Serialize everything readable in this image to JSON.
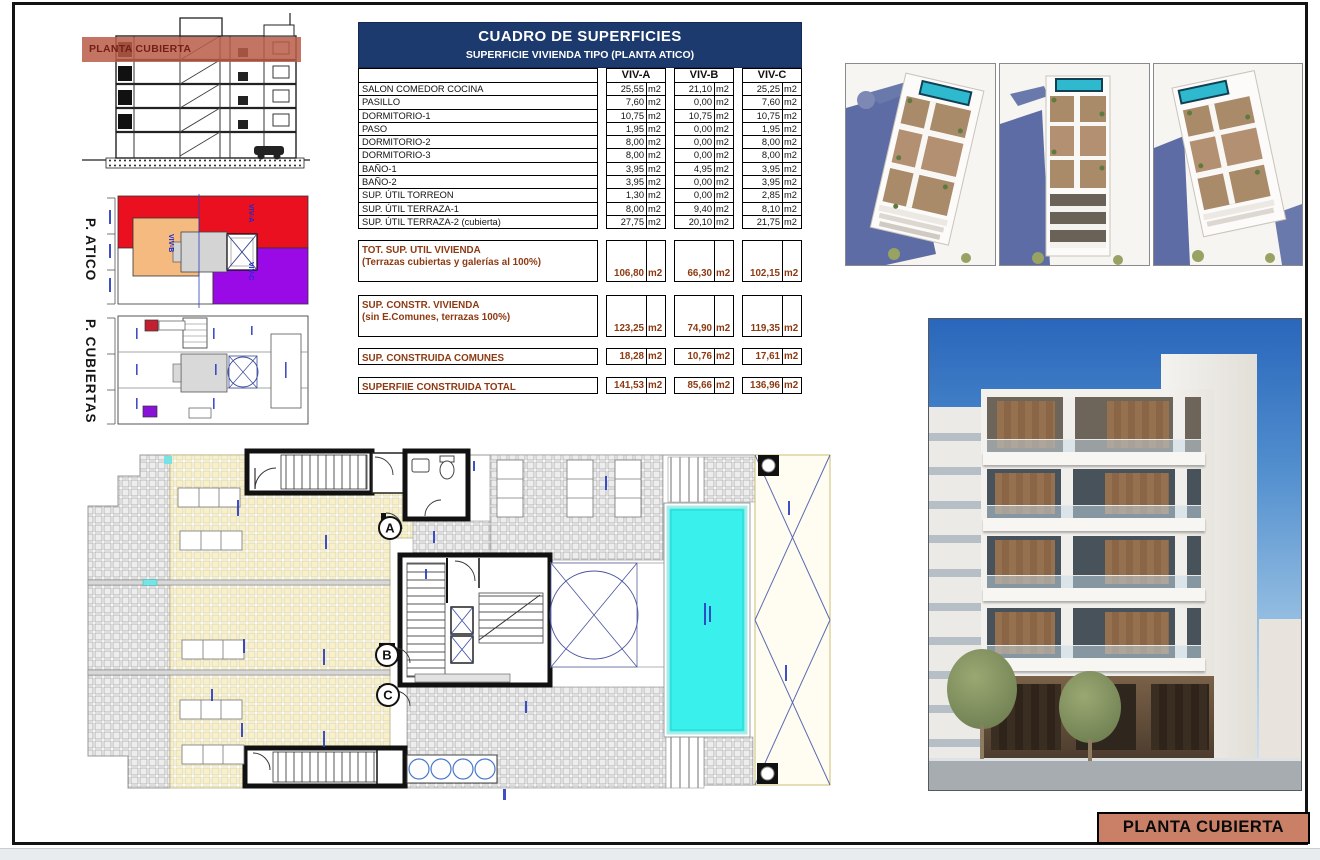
{
  "sheet": {
    "section_band_label": "PLANTA CUBIERTA",
    "plate_label": "PLANTA CUBIERTA"
  },
  "left_diagrams": {
    "atico_label": "P. ATICO",
    "cubiertas_label": "P. CUBIERTAS",
    "units": [
      "VIV-A",
      "VIV-B",
      "VIV-C"
    ]
  },
  "table": {
    "title": "CUADRO DE SUPERFICIES",
    "subtitle": "SUPERFICIE VIVIENDA TIPO  (PLANTA ATICO)",
    "columns": [
      "VIV-A",
      "VIV-B",
      "VIV-C"
    ],
    "unit": "m2",
    "rows": [
      {
        "label": "SALON COMEDOR COCINA",
        "values": [
          "25,55",
          "21,10",
          "25,25"
        ]
      },
      {
        "label": "PASILLO",
        "values": [
          "7,60",
          "0,00",
          "7,60"
        ]
      },
      {
        "label": "DORMITORIO-1",
        "values": [
          "10,75",
          "10,75",
          "10,75"
        ]
      },
      {
        "label": "PASO",
        "values": [
          "1,95",
          "0,00",
          "1,95"
        ]
      },
      {
        "label": "DORMITORIO-2",
        "values": [
          "8,00",
          "0,00",
          "8,00"
        ]
      },
      {
        "label": "DORMITORIO-3",
        "values": [
          "8,00",
          "0,00",
          "8,00"
        ]
      },
      {
        "label": "BAÑO-1",
        "values": [
          "3,95",
          "4,95",
          "3,95"
        ]
      },
      {
        "label": "BAÑO-2",
        "values": [
          "3,95",
          "0,00",
          "3,95"
        ]
      },
      {
        "label": "SUP. ÚTIL TORREON",
        "values": [
          "1,30",
          "0,00",
          "2,85"
        ]
      },
      {
        "label": "SUP. ÚTIL TERRAZA-1",
        "values": [
          "8,00",
          "9,40",
          "8,10"
        ]
      },
      {
        "label": "SUP. ÚTIL TERRAZA-2 (cubierta)",
        "values": [
          "27,75",
          "20,10",
          "21,75"
        ]
      }
    ],
    "summary_rows": [
      {
        "label": "TOT. SUP. UTIL VIVIENDA",
        "sublabel": "(Terrazas cubiertas y galerías al 100%)",
        "values": [
          "106,80",
          "66,30",
          "102,15"
        ]
      },
      {
        "label": "SUP. CONSTR. VIVIENDA",
        "sublabel": "(sin E.Comunes, terrazas 100%)",
        "values": [
          "123,25",
          "74,90",
          "119,35"
        ]
      },
      {
        "label": "SUP. CONSTRUIDA COMUNES",
        "sublabel": "",
        "values": [
          "18,28",
          "10,76",
          "17,61"
        ]
      },
      {
        "label": "SUPERFIIE CONSTRUIDA TOTAL",
        "sublabel": "",
        "values": [
          "141,53",
          "85,66",
          "136,96"
        ]
      }
    ]
  },
  "plan": {
    "markers": [
      "A",
      "B",
      "C"
    ]
  }
}
